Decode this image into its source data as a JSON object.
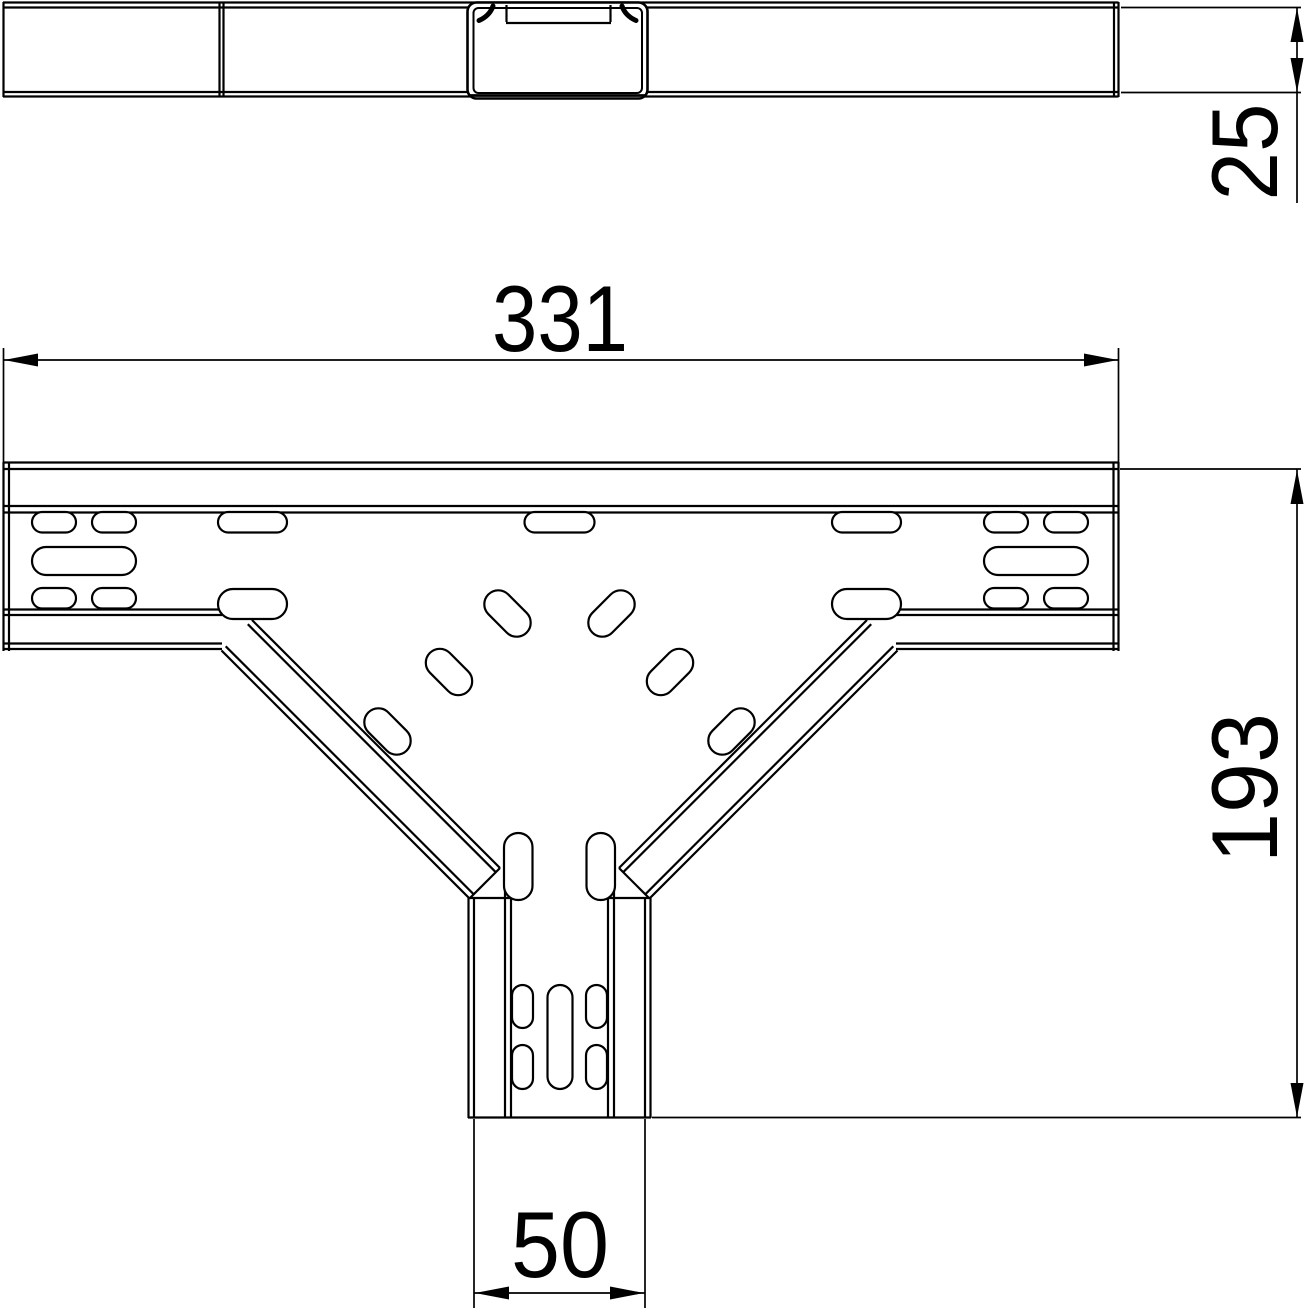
{
  "drawing": {
    "type": "technical-dimension-drawing",
    "views": {
      "top": "side-elevation-with-coupler",
      "main": "t-branch-plan-view"
    },
    "dimensions": {
      "side_height": "25",
      "overall_width": "331",
      "branch_depth": "193",
      "branch_width": "50"
    },
    "colors": {
      "line": "#000000",
      "background": "#ffffff"
    }
  }
}
